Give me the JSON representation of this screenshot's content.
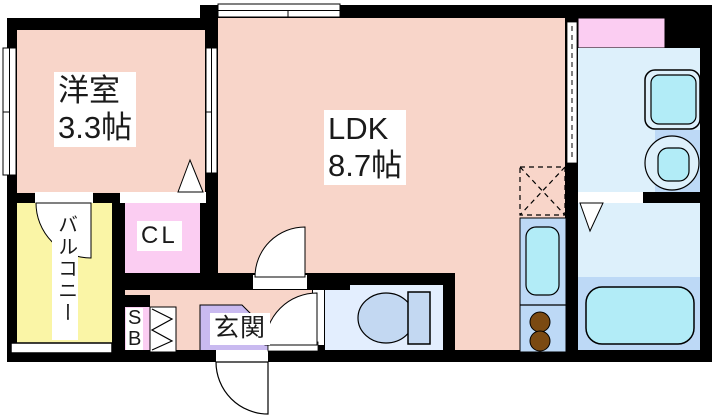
{
  "floorplan": {
    "rooms": {
      "western_room": {
        "name": "洋室",
        "size": "3.3帖"
      },
      "ldk": {
        "name": "LDK",
        "size": "8.7帖"
      },
      "balcony": {
        "name": "バルコニー"
      },
      "closet": {
        "name": "CL"
      },
      "shoe_box": {
        "name": "SB"
      },
      "entrance": {
        "name": "玄関"
      }
    },
    "fixtures": {
      "toilet": "toilet-icon",
      "bathtub": "bathtub-icon",
      "washing_machine": "washing-machine-icon",
      "wash_basin": "wash-basin-icon",
      "kitchen_sink": "kitchen-sink-icon",
      "stove_burners": "stove-burner-icon",
      "refrigerator_space": "refrigerator-space-icon"
    },
    "colors": {
      "wall": "#000000",
      "room_floor": "#f8d5c9",
      "closet_pink": "#fbcdf2",
      "entrance_lavender": "#c9baf0",
      "balcony_yellow": "#faf5a6",
      "wet_light": "#ddf0fb",
      "wet_medium": "#bdd9f6",
      "fixture_cyan": "#b2ecf7",
      "toilet_room": "#e3eefe",
      "toilet_fixture": "#c3d8f2",
      "burner_brown": "#7b4a12",
      "background": "#ffffff",
      "opening_white": "#ffffff"
    }
  }
}
